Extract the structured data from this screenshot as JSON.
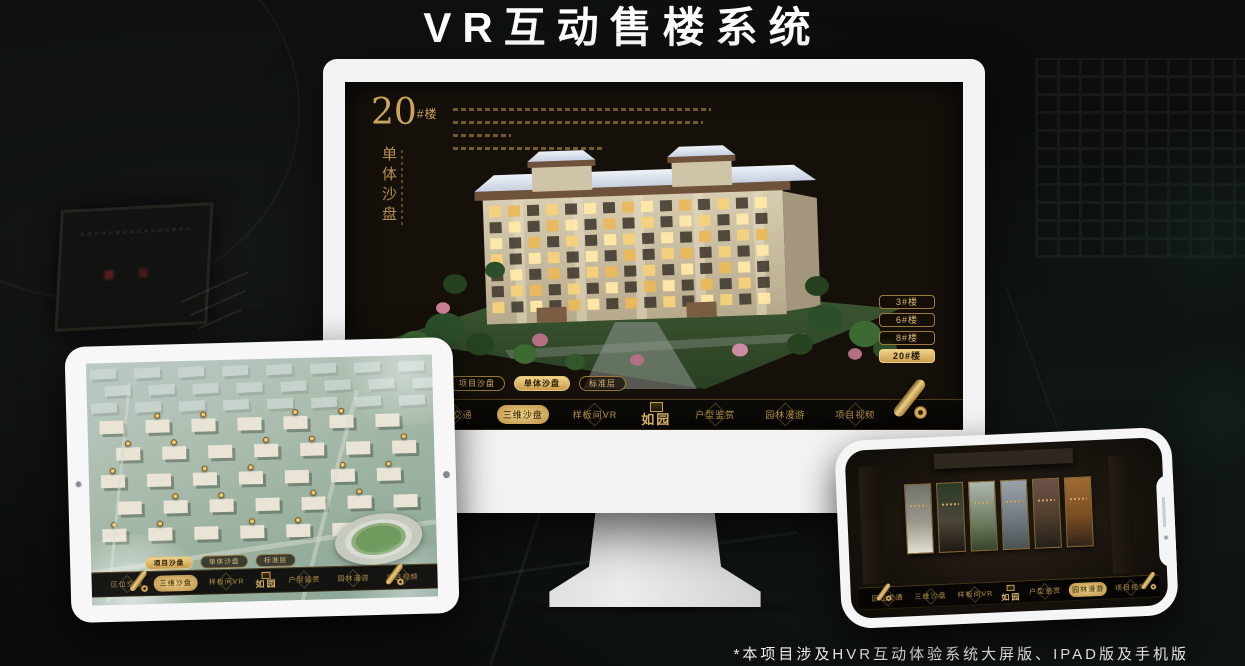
{
  "poster": {
    "title": "VR互动售楼系统",
    "footnote": "*本项目涉及HVR互动体验系统大屏版、IPAD版及手机版"
  },
  "brand": {
    "logo_text": "如园"
  },
  "colors": {
    "gold": "#c9a45f",
    "gold_bright": "#ecd084",
    "screen_bg": "#15100a",
    "navbar_bg": "#0a0806",
    "frame_white": "#f3f3f3"
  },
  "monitor": {
    "headline": {
      "number": "20",
      "suffix": "#楼",
      "subtitle": "单体沙盘"
    },
    "floor_buttons": [
      {
        "label": "3#楼"
      },
      {
        "label": "6#楼"
      },
      {
        "label": "8#楼"
      },
      {
        "label": "20#楼",
        "active": true
      }
    ],
    "sub_tabs": [
      {
        "label": "项目沙盘"
      },
      {
        "label": "单体沙盘",
        "active": true
      },
      {
        "label": "标准层"
      }
    ],
    "nav_left": [
      {
        "label": "区位交通"
      },
      {
        "label": "三维沙盘",
        "active": true
      },
      {
        "label": "样板间VR"
      }
    ],
    "nav_right": [
      {
        "label": "户型鉴赏"
      },
      {
        "label": "园林漫游"
      },
      {
        "label": "项目视频"
      }
    ]
  },
  "tablet": {
    "sub_tabs": [
      {
        "label": "项目沙盘",
        "active": true
      },
      {
        "label": "单体沙盘"
      },
      {
        "label": "标准层"
      }
    ],
    "nav_left": [
      {
        "label": "区位交通"
      },
      {
        "label": "三维沙盘",
        "active": true
      },
      {
        "label": "样板间VR"
      }
    ],
    "nav_right": [
      {
        "label": "户型鉴赏"
      },
      {
        "label": "园林漫游"
      },
      {
        "label": "项目视频"
      }
    ]
  },
  "phone": {
    "nav_left": [
      {
        "label": "区位交通"
      },
      {
        "label": "三维沙盘"
      },
      {
        "label": "样板间VR"
      }
    ],
    "nav_right": [
      {
        "label": "户型鉴赏"
      },
      {
        "label": "园林漫游",
        "active": true
      },
      {
        "label": "项目视频"
      }
    ],
    "panels": [
      {
        "grad": "linear-gradient(#70736c,#9b978d 55%,#e3ded2)"
      },
      {
        "grad": "linear-gradient(#2b3a26,#4c4638 55%,#1e1913)"
      },
      {
        "grad": "linear-gradient(#aeb6ae,#6c7c5e 60%,#39442c)"
      },
      {
        "grad": "linear-gradient(#9aa3a8,#717b81 55%,#4b5254)"
      },
      {
        "grad": "linear-gradient(#6b5148,#53402f 50%,#23201a)"
      },
      {
        "grad": "linear-gradient(#a06b32,#7a4e22 55%,#31241a)"
      }
    ]
  }
}
